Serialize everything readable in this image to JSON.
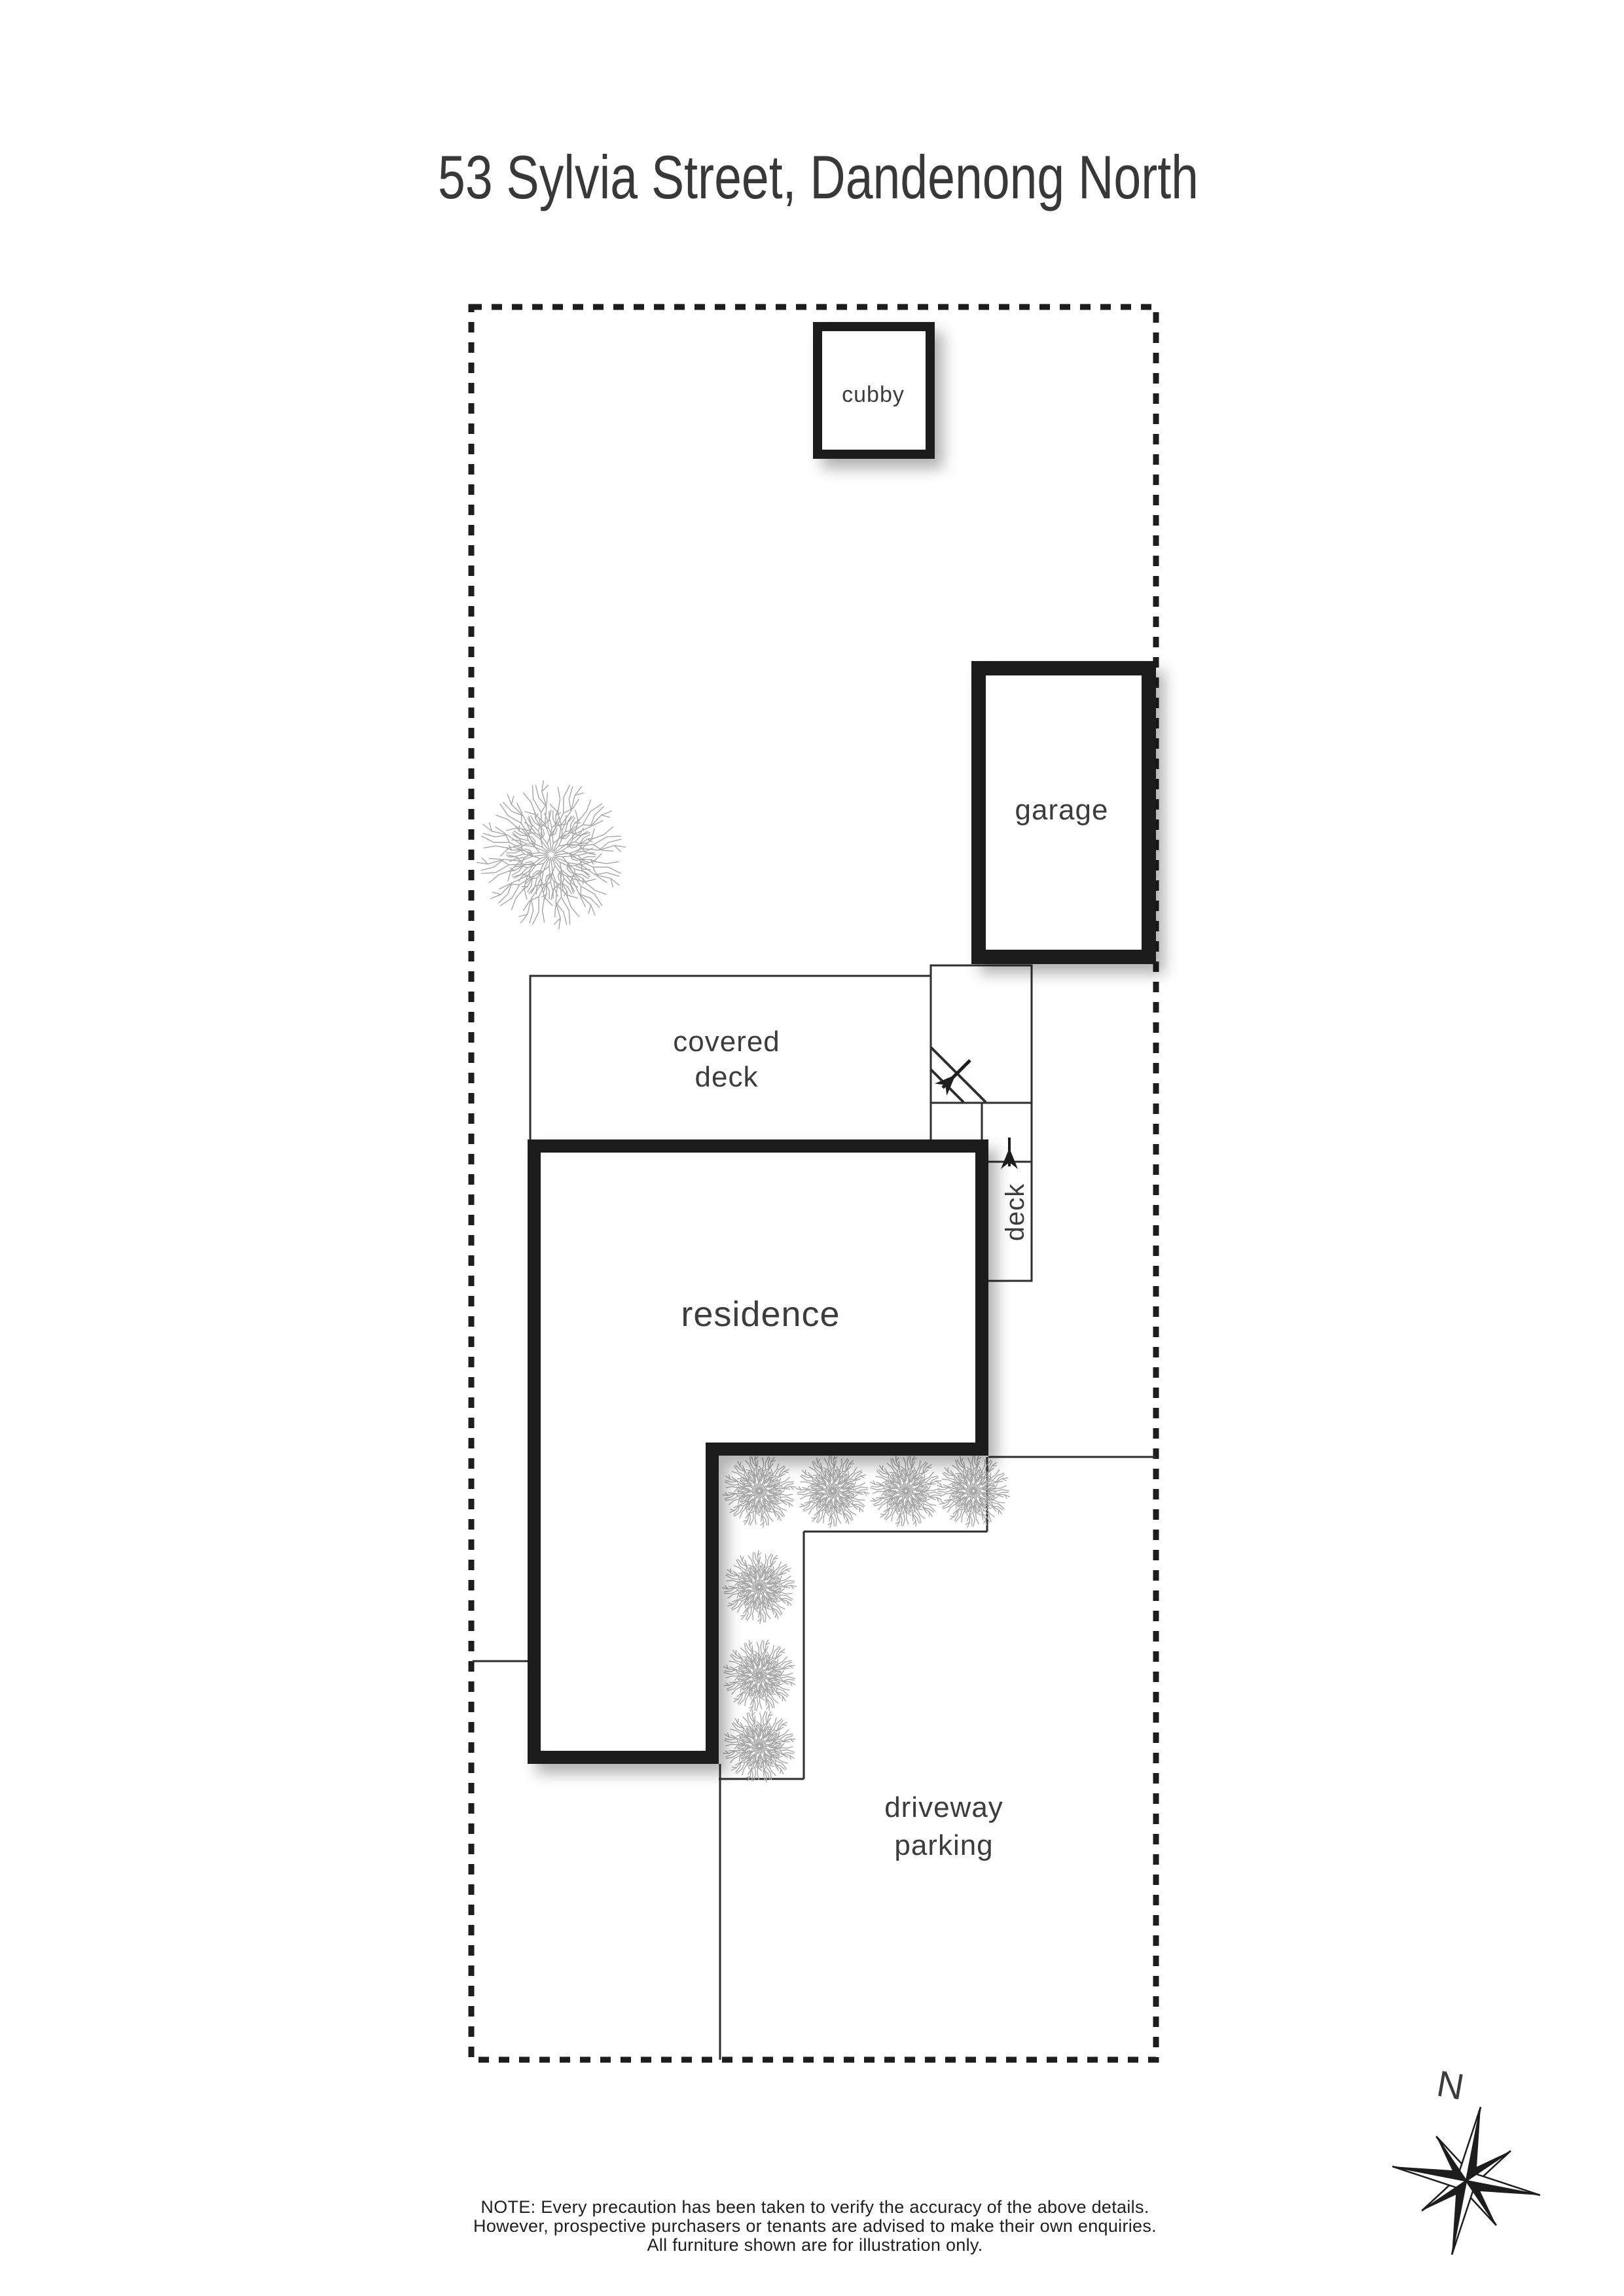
{
  "page": {
    "title": "53 Sylvia Street, Dandenong North",
    "background": "#ffffff"
  },
  "plan": {
    "labels": {
      "cubby": "cubby",
      "garage": "garage",
      "covered_deck": [
        "covered",
        "deck"
      ],
      "residence": "residence",
      "deck": "deck",
      "driveway": [
        "driveway",
        "parking"
      ]
    },
    "compass": {
      "north": "N"
    },
    "colors": {
      "outline": "#1d1d1d",
      "thin_line": "#2e2e2e",
      "plant": "#a6a6a6",
      "label_text": "#3c3c3c"
    }
  },
  "footer": {
    "note_lines": [
      "NOTE: Every precaution has been taken to verify the accuracy of the above details.",
      "However, prospective purchasers or tenants are advised to make their own enquiries.",
      "All furniture shown are for illustration only."
    ]
  }
}
